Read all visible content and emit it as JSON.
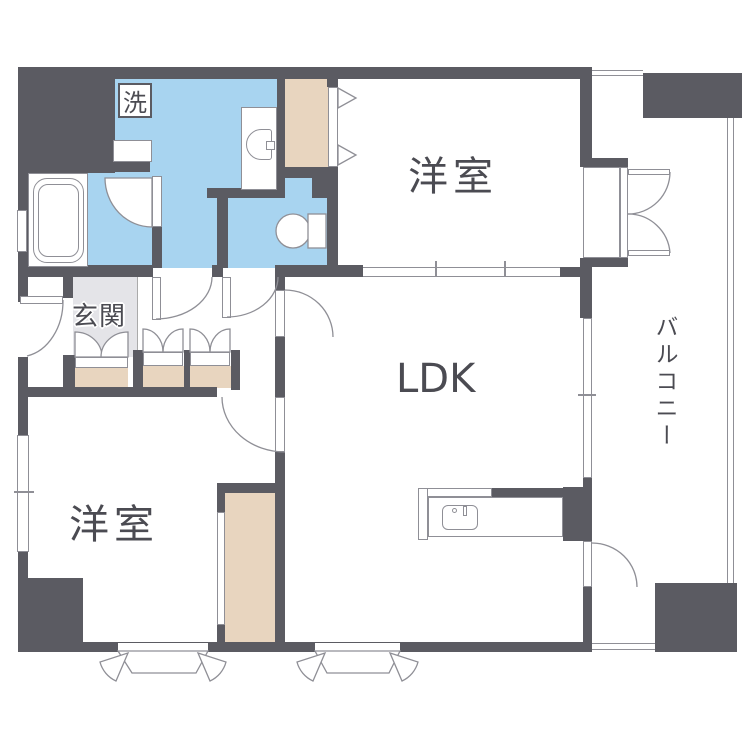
{
  "app": {
    "type": "apartment-floor-plan"
  },
  "labels": {
    "western_room_top": "洋室",
    "western_room_bottom": "洋室",
    "ldk": "LDK",
    "entrance": "玄関",
    "washer": "洗",
    "balcony": "バルコニー"
  },
  "colors": {
    "wall": "#5b5b62",
    "water": "#a8d4f0",
    "closet": "#e8d5bf",
    "entrance_floor": "#e4e4e8",
    "line": "#8f8f96",
    "text": "#4b4b52",
    "bg": "#ffffff"
  }
}
